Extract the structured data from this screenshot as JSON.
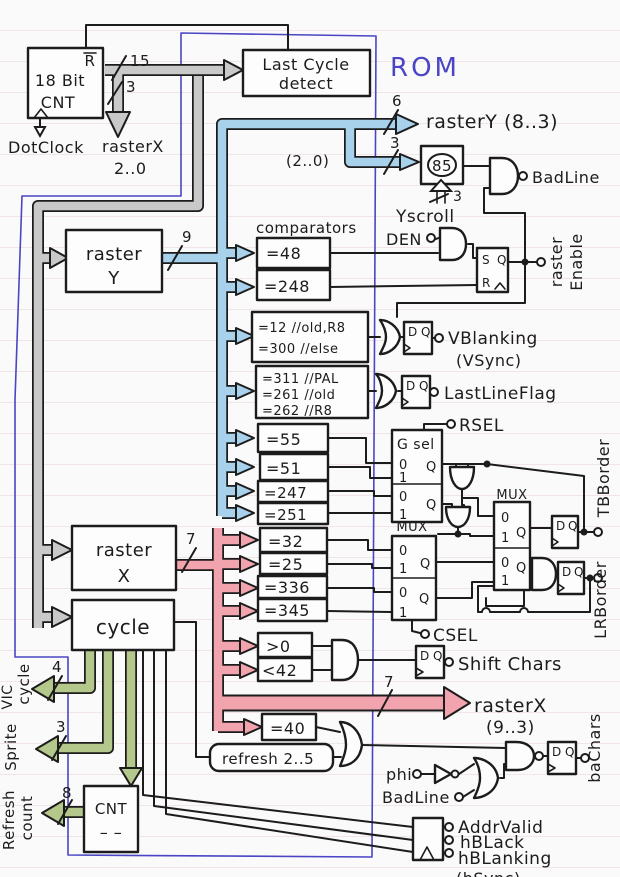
{
  "colors": {
    "ink": "#1c1c1c",
    "bus_gray": "#c9c9c9",
    "bus_blue": "#a8d2ec",
    "bus_pink": "#f2a4ae",
    "bus_green": "#b5c88c",
    "rom_blue": "#4a45c4",
    "paper": "#fbfafa"
  },
  "top": {
    "cnt_reset": "R",
    "cnt_line1": "18 Bit",
    "cnt_line2": "CNT",
    "dotclock": "DotClock",
    "w15": "15",
    "w3": "3",
    "rasterx_lo_1": "rasterX",
    "rasterx_lo_2": "2..0",
    "last_cycle_1": "Last Cycle",
    "last_cycle_2": "detect",
    "rom": "ROM",
    "w6": "6",
    "rastery_out": "rasterY (8..3)",
    "w3_cmp": "3",
    "bits20": "(2..0)",
    "cmp85": "85",
    "w3_yscroll": "3",
    "yscroll": "Yscroll",
    "badline": "BadLine"
  },
  "enable": {
    "comparators": "comparators",
    "den": "DEN",
    "c48": "=48",
    "c248": "=248",
    "s": "S",
    "q": "Q",
    "r": "R",
    "out1": "raster",
    "out2": "Enable"
  },
  "vblank": {
    "c1": "=12 //old,R8",
    "c2": "=300 //else",
    "out1": "VBlanking",
    "out2": "(VSync)"
  },
  "lastline": {
    "c1": "=311 //PAL",
    "c2": "=261 //old",
    "c3": "=262 //R8",
    "out": "LastLineFlag"
  },
  "yborder": {
    "rsel": "RSEL",
    "gsel": "G sel",
    "c55": "=55",
    "c51": "=51",
    "c247": "=247",
    "c251": "=251",
    "mux": "MUX",
    "tbborder": "TBBorder"
  },
  "xborder": {
    "c32": "=32",
    "c25": "=25",
    "c336": "=336",
    "c345": "=345",
    "mux": "MUX",
    "csel": "CSEL",
    "lrborder": "LRBorder"
  },
  "shift": {
    "gt0": ">0",
    "lt42": "<42",
    "out": "Shift Chars"
  },
  "xout": {
    "w7": "7",
    "t1": "rasterX",
    "t2": "(9..3)"
  },
  "ba": {
    "c40": "=40",
    "refresh": "refresh 2..5",
    "phi": "phi",
    "badline": "BadLine",
    "out": "baChars"
  },
  "left": {
    "ry1": "raster",
    "ry2": "Y",
    "w9": "9",
    "rx1": "raster",
    "rx2": "X",
    "w7": "7",
    "cycle": "cycle",
    "w4": "4",
    "vic1": "VIC",
    "vic2": "cycle",
    "w3": "3",
    "sprite": "Sprite",
    "w8": "8",
    "rc1": "Refresh",
    "rc2": "count",
    "cnt": "CNT",
    "cnt_dashes": "– –"
  },
  "bottom": {
    "addrvalid": "AddrValid",
    "hblack": "hBLack",
    "hblanking": "hBLanking",
    "cut": "(hSync)"
  },
  "ff": {
    "d": "D",
    "q": "Q"
  },
  "mux_io": {
    "zero": "0",
    "one": "1",
    "q": "Q"
  }
}
